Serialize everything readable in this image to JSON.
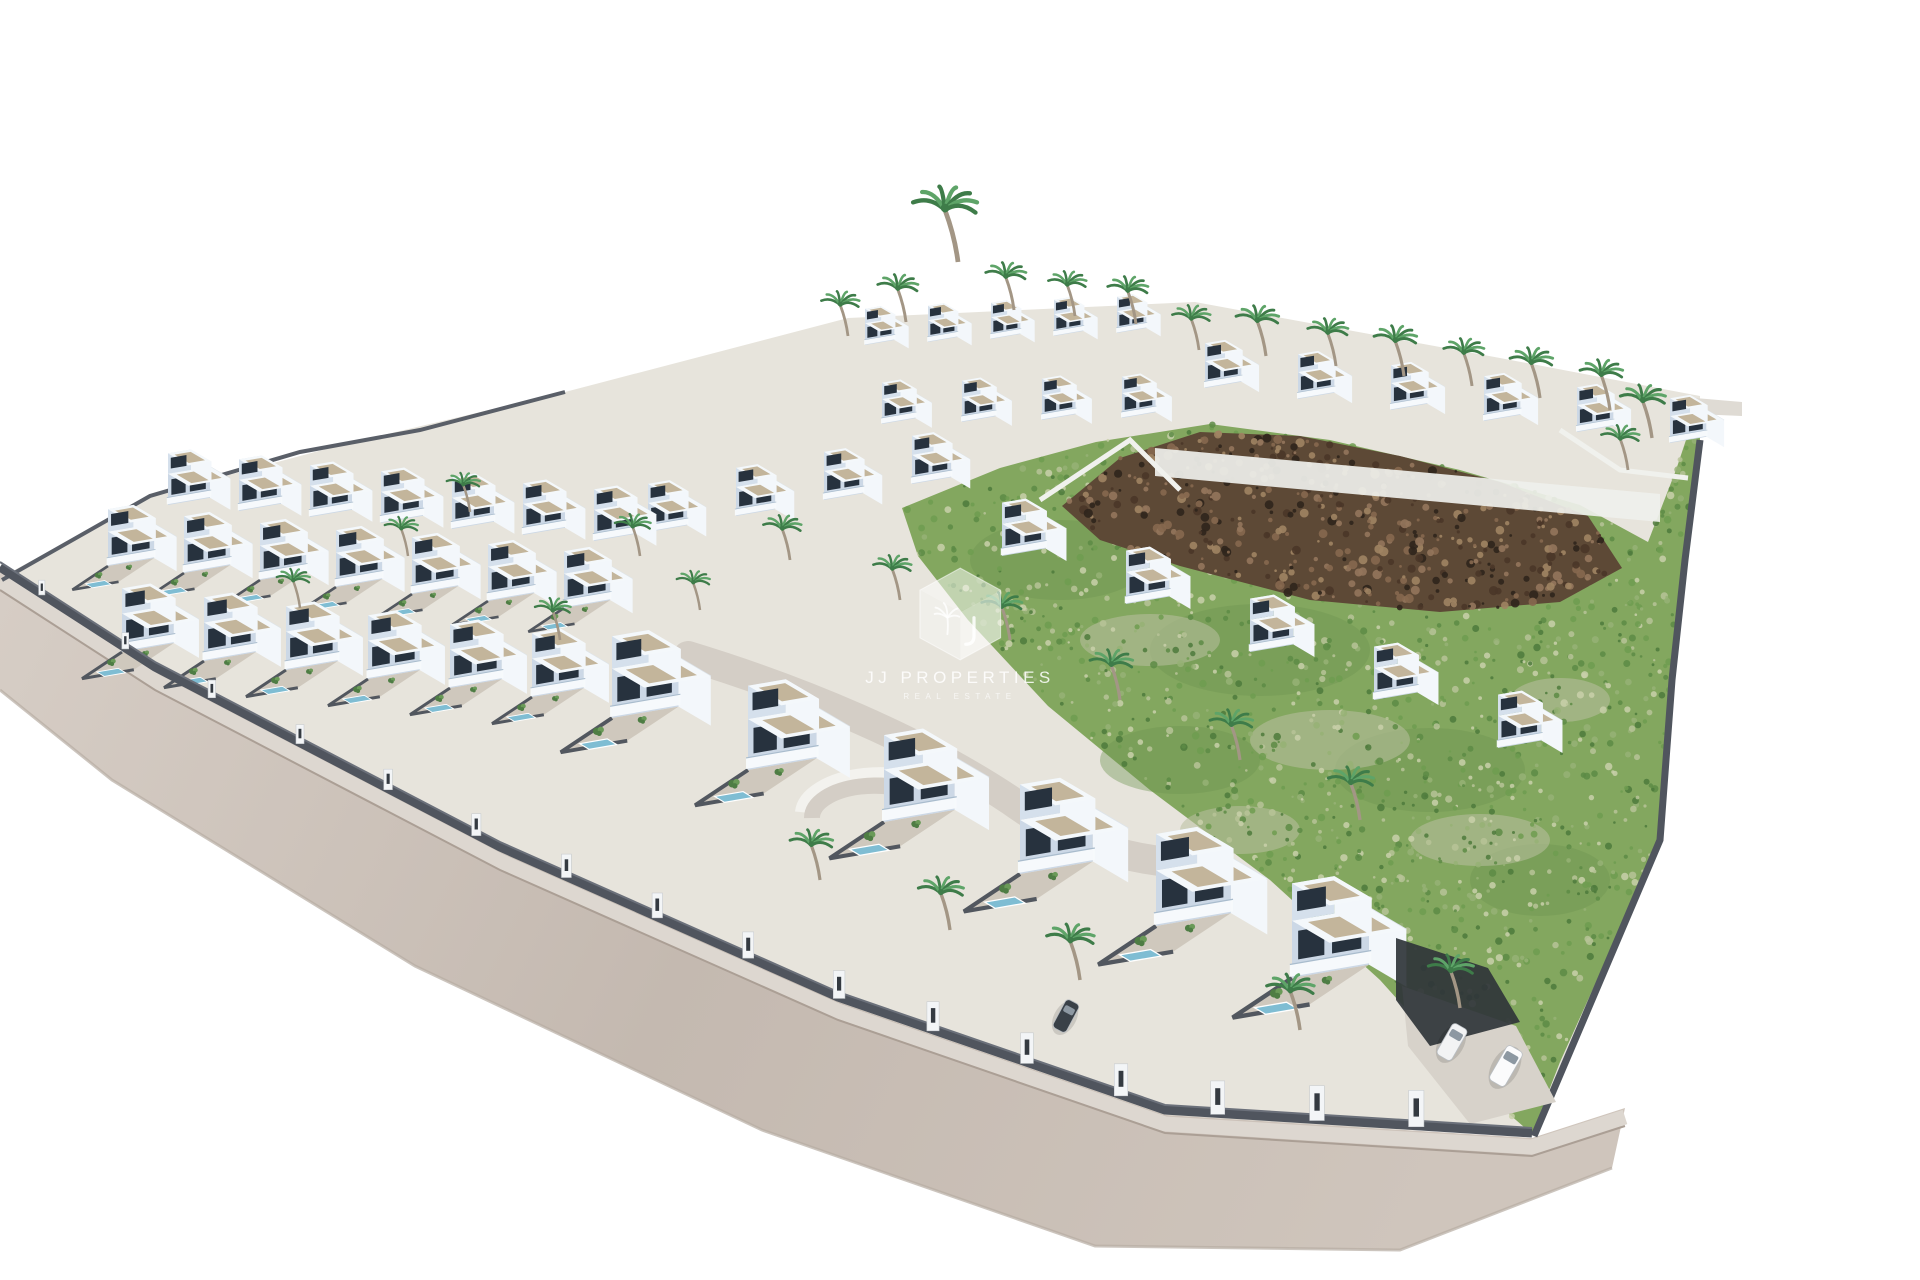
{
  "watermark": {
    "title": "JJ PROPERTIES",
    "subtitle": "REAL ESTATE"
  },
  "colors": {
    "background": "#ffffff",
    "plot": "#e7e4dc",
    "road": {
      "light": "#d6cdc5",
      "mid": "#c4b9b0",
      "warm": "#cfc5bc",
      "sidewalk": "#ddd7d0",
      "curb": "#ab9f95",
      "outer": "#b7aca2"
    },
    "wall": "#50555e",
    "wallHi": "#6b707a",
    "fence": "#5a5f68",
    "terrace": "#eff0ec",
    "innerRoad": "#d4cec6",
    "innerRoadWall": "#f3f2ee",
    "driveway": "#d7d2ca",
    "darkBed": "#30353a",
    "green": {
      "base": "#83a75f",
      "deep": "#6d9350",
      "patch": "#b9c0a0",
      "speckles": [
        "#5d8b45",
        "#6f9c50",
        "#97b276",
        "#b7c398",
        "#c9d0aa",
        "#4e7a3c"
      ]
    },
    "rock": {
      "base": "#5d4936",
      "speckles": [
        "#4a3628",
        "#86684f",
        "#93765c",
        "#2f251c",
        "#a08463"
      ]
    },
    "villa": {
      "front": "#ccd8e6",
      "side": "#f3f7fb",
      "upperFront": "#d5e0ec",
      "roofTop": "#f4f8fb",
      "roofEdge": "#dde4ea",
      "gravel": "#c3b59b",
      "window": "#27323e",
      "balcony": "#f7fafc",
      "balconyGlass": "#a9bccd",
      "garden": "#cfc8bd",
      "gardenWall": "#52575f",
      "pool": "#7fbdd3"
    },
    "palm": {
      "trunk": "#a39685",
      "frond": "#3e7c49",
      "frondLight": "#5ea468"
    },
    "tree": {
      "dark": "#4e7d44",
      "light": "#6a9a58"
    }
  },
  "scene": {
    "canvas": [
      1920,
      1280
    ],
    "plotOutline": [
      [
        0,
        578
      ],
      [
        150,
        496
      ],
      [
        345,
        444
      ],
      [
        565,
        392
      ],
      [
        848,
        318
      ],
      [
        1195,
        302
      ],
      [
        1500,
        358
      ],
      [
        1700,
        396
      ],
      [
        1700,
        440
      ],
      [
        1685,
        560
      ],
      [
        1672,
        680
      ],
      [
        1660,
        840
      ],
      [
        1534,
        1136
      ],
      [
        1165,
        1118
      ],
      [
        838,
        1008
      ],
      [
        500,
        858
      ],
      [
        155,
        678
      ]
    ],
    "road": {
      "upper": [
        [
          0,
          572
        ],
        [
          155,
          672
        ],
        [
          500,
          852
        ],
        [
          838,
          1002
        ],
        [
          1165,
          1115
        ],
        [
          1532,
          1138
        ],
        [
          1625,
          1108
        ]
      ],
      "outer": [
        [
          1612,
          1168
        ],
        [
          1400,
          1250
        ],
        [
          1095,
          1246
        ],
        [
          762,
          1130
        ],
        [
          415,
          966
        ],
        [
          112,
          780
        ],
        [
          0,
          690
        ]
      ],
      "pillarTs": [
        0.03,
        0.09,
        0.15,
        0.21,
        0.27,
        0.33,
        0.39,
        0.45,
        0.51,
        0.57,
        0.63,
        0.69,
        0.75,
        0.81,
        0.87,
        0.93
      ]
    },
    "innerRoad": {
      "path": "M 688 656 C 800 690 920 740 1010 800 C 1060 836 1110 856 1168 862",
      "crescentOuter": "M 800 812 A 80 42 0 0 1 952 796",
      "crescentInner": "M 812 818 A 62 32 0 0 1 930 804"
    },
    "green": {
      "area": [
        [
          902,
          508
        ],
        [
          1000,
          468
        ],
        [
          1096,
          442
        ],
        [
          1210,
          424
        ],
        [
          1330,
          440
        ],
        [
          1460,
          470
        ],
        [
          1580,
          505
        ],
        [
          1648,
          542
        ],
        [
          1676,
          470
        ],
        [
          1698,
          404
        ],
        [
          1700,
          440
        ],
        [
          1685,
          560
        ],
        [
          1672,
          680
        ],
        [
          1660,
          840
        ],
        [
          1560,
          1062
        ],
        [
          1532,
          1134
        ],
        [
          1470,
          1080
        ],
        [
          1380,
          980
        ],
        [
          1270,
          880
        ],
        [
          1150,
          790
        ],
        [
          1048,
          706
        ],
        [
          968,
          620
        ],
        [
          918,
          556
        ]
      ],
      "deepSpots": [
        [
          1060,
          560,
          90,
          40
        ],
        [
          1260,
          650,
          110,
          46
        ],
        [
          1430,
          770,
          95,
          42
        ],
        [
          1180,
          760,
          80,
          34
        ],
        [
          1540,
          880,
          70,
          36
        ]
      ],
      "patches": [
        [
          1150,
          640,
          70,
          26
        ],
        [
          1330,
          740,
          80,
          30
        ],
        [
          1480,
          840,
          70,
          26
        ],
        [
          1240,
          830,
          60,
          24
        ],
        [
          1560,
          700,
          50,
          22
        ]
      ],
      "speckleCount": 1500,
      "seed": 7
    },
    "rocks": {
      "area": [
        [
          1062,
          506
        ],
        [
          1120,
          458
        ],
        [
          1200,
          432
        ],
        [
          1300,
          436
        ],
        [
          1400,
          456
        ],
        [
          1500,
          482
        ],
        [
          1588,
          516
        ],
        [
          1622,
          568
        ],
        [
          1560,
          602
        ],
        [
          1440,
          612
        ],
        [
          1310,
          600
        ],
        [
          1180,
          566
        ],
        [
          1100,
          540
        ]
      ],
      "speckleCount": 520,
      "seed": 13
    },
    "terraces": [
      [
        [
          1155,
          448
        ],
        [
          1660,
          494
        ],
        [
          1660,
          522
        ],
        [
          1155,
          476
        ]
      ]
    ],
    "whiteWalls": [
      [
        [
          1040,
          500
        ],
        [
          1130,
          440
        ],
        [
          1180,
          490
        ]
      ],
      [
        [
          1560,
          430
        ],
        [
          1620,
          470
        ],
        [
          1688,
          478
        ]
      ]
    ],
    "pad": [
      [
        1695,
        398
      ],
      [
        1742,
        402
      ],
      [
        1742,
        416
      ],
      [
        1695,
        414
      ]
    ],
    "fenceTopLeft": [
      [
        2,
        580
      ],
      [
        150,
        496
      ],
      [
        300,
        452
      ],
      [
        420,
        430
      ],
      [
        565,
        392
      ]
    ],
    "rightWall": [
      [
        1700,
        440
      ],
      [
        1685,
        560
      ],
      [
        1672,
        680
      ],
      [
        1660,
        840
      ],
      [
        1534,
        1136
      ]
    ],
    "villaRows": [
      {
        "name": "back-upper-left",
        "start": [
          865,
          345
        ],
        "step": [
          63,
          -3
        ],
        "count": 5,
        "scale": 0.42,
        "pool": false
      },
      {
        "name": "back-lower-left",
        "start": [
          882,
          424
        ],
        "step": [
          80,
          -2
        ],
        "count": 4,
        "scale": 0.48,
        "pool": false
      },
      {
        "name": "back-right",
        "start": [
          1205,
          388
        ],
        "step": [
          93,
          11
        ],
        "count": 6,
        "scale": 0.52,
        "pool": false
      },
      {
        "name": "mid-terrace",
        "start": [
          648,
          532
        ],
        "step": [
          88,
          -16
        ],
        "count": 4,
        "scale": 0.56,
        "pool": false
      },
      {
        "name": "left-row-1",
        "start": [
          168,
          505
        ],
        "step": [
          71,
          6
        ],
        "count": 7,
        "scale": 0.6,
        "pool": false
      },
      {
        "name": "left-row-2",
        "start": [
          108,
          566
        ],
        "step": [
          76,
          7
        ],
        "count": 7,
        "scale": 0.66,
        "pool": true
      },
      {
        "name": "left-row-3",
        "start": [
          122,
          652
        ],
        "step": [
          82,
          9
        ],
        "count": 6,
        "scale": 0.74,
        "pool": true
      },
      {
        "name": "mid-right",
        "start": [
          1002,
          556
        ],
        "step": [
          124,
          48
        ],
        "count": 5,
        "scale": 0.62,
        "pool": false
      },
      {
        "name": "front-row",
        "start": [
          612,
          718
        ],
        "step": [
          136,
          52
        ],
        "count": 6,
        "scale": 0.95,
        "scaleStep": 0.03,
        "pool": true
      }
    ],
    "palms": [
      [
        848,
        336,
        0.8
      ],
      [
        906,
        322,
        0.85
      ],
      [
        958,
        262,
        1.35
      ],
      [
        1014,
        310,
        0.85
      ],
      [
        1075,
        316,
        0.8
      ],
      [
        1136,
        324,
        0.85
      ],
      [
        1199,
        350,
        0.8
      ],
      [
        1266,
        356,
        0.9
      ],
      [
        1336,
        366,
        0.85
      ],
      [
        1404,
        376,
        0.9
      ],
      [
        1472,
        386,
        0.85
      ],
      [
        1540,
        398,
        0.9
      ],
      [
        1610,
        410,
        0.9
      ],
      [
        1652,
        438,
        0.95
      ],
      [
        1628,
        470,
        0.8
      ],
      [
        470,
        512,
        0.7
      ],
      [
        640,
        556,
        0.75
      ],
      [
        790,
        560,
        0.8
      ],
      [
        900,
        600,
        0.8
      ],
      [
        1010,
        640,
        0.85
      ],
      [
        700,
        610,
        0.7
      ],
      [
        408,
        556,
        0.7
      ],
      [
        300,
        608,
        0.7
      ],
      [
        560,
        640,
        0.75
      ],
      [
        1120,
        700,
        0.9
      ],
      [
        1240,
        760,
        0.9
      ],
      [
        1360,
        820,
        0.95
      ],
      [
        1300,
        1030,
        1.0
      ],
      [
        1460,
        1008,
        0.95
      ],
      [
        820,
        880,
        0.9
      ],
      [
        950,
        930,
        0.95
      ],
      [
        1080,
        980,
        1.0
      ]
    ],
    "trees": [
      [
        70,
        598,
        1.0
      ],
      [
        108,
        576,
        1.2
      ],
      [
        150,
        552,
        1.0
      ],
      [
        196,
        530,
        1.3
      ],
      [
        250,
        510,
        1.0
      ],
      [
        60,
        618,
        0.8
      ],
      [
        340,
        520,
        0.8
      ],
      [
        420,
        545,
        0.9
      ],
      [
        1590,
        560,
        0.9
      ],
      [
        1620,
        640,
        0.8
      ],
      [
        1600,
        760,
        0.9
      ],
      [
        1570,
        900,
        0.85
      ]
    ],
    "driveway": [
      [
        1402,
        986
      ],
      [
        1516,
        1026
      ],
      [
        1556,
        1102
      ],
      [
        1470,
        1124
      ],
      [
        1408,
        1046
      ]
    ],
    "darkBeds": [
      [
        [
          1396,
          938
        ],
        [
          1488,
          968
        ],
        [
          1520,
          1022
        ],
        [
          1430,
          1046
        ],
        [
          1396,
          1000
        ]
      ]
    ],
    "cars": [
      {
        "x": 1452,
        "y": 1042,
        "angle": 30,
        "w": 17,
        "h": 36,
        "body": "#f2f3f4"
      },
      {
        "x": 1506,
        "y": 1066,
        "angle": 30,
        "w": 18,
        "h": 40,
        "body": "#fbfbfc"
      },
      {
        "x": 1066,
        "y": 1016,
        "angle": 28,
        "w": 15,
        "h": 32,
        "body": "#3a4148"
      }
    ]
  }
}
